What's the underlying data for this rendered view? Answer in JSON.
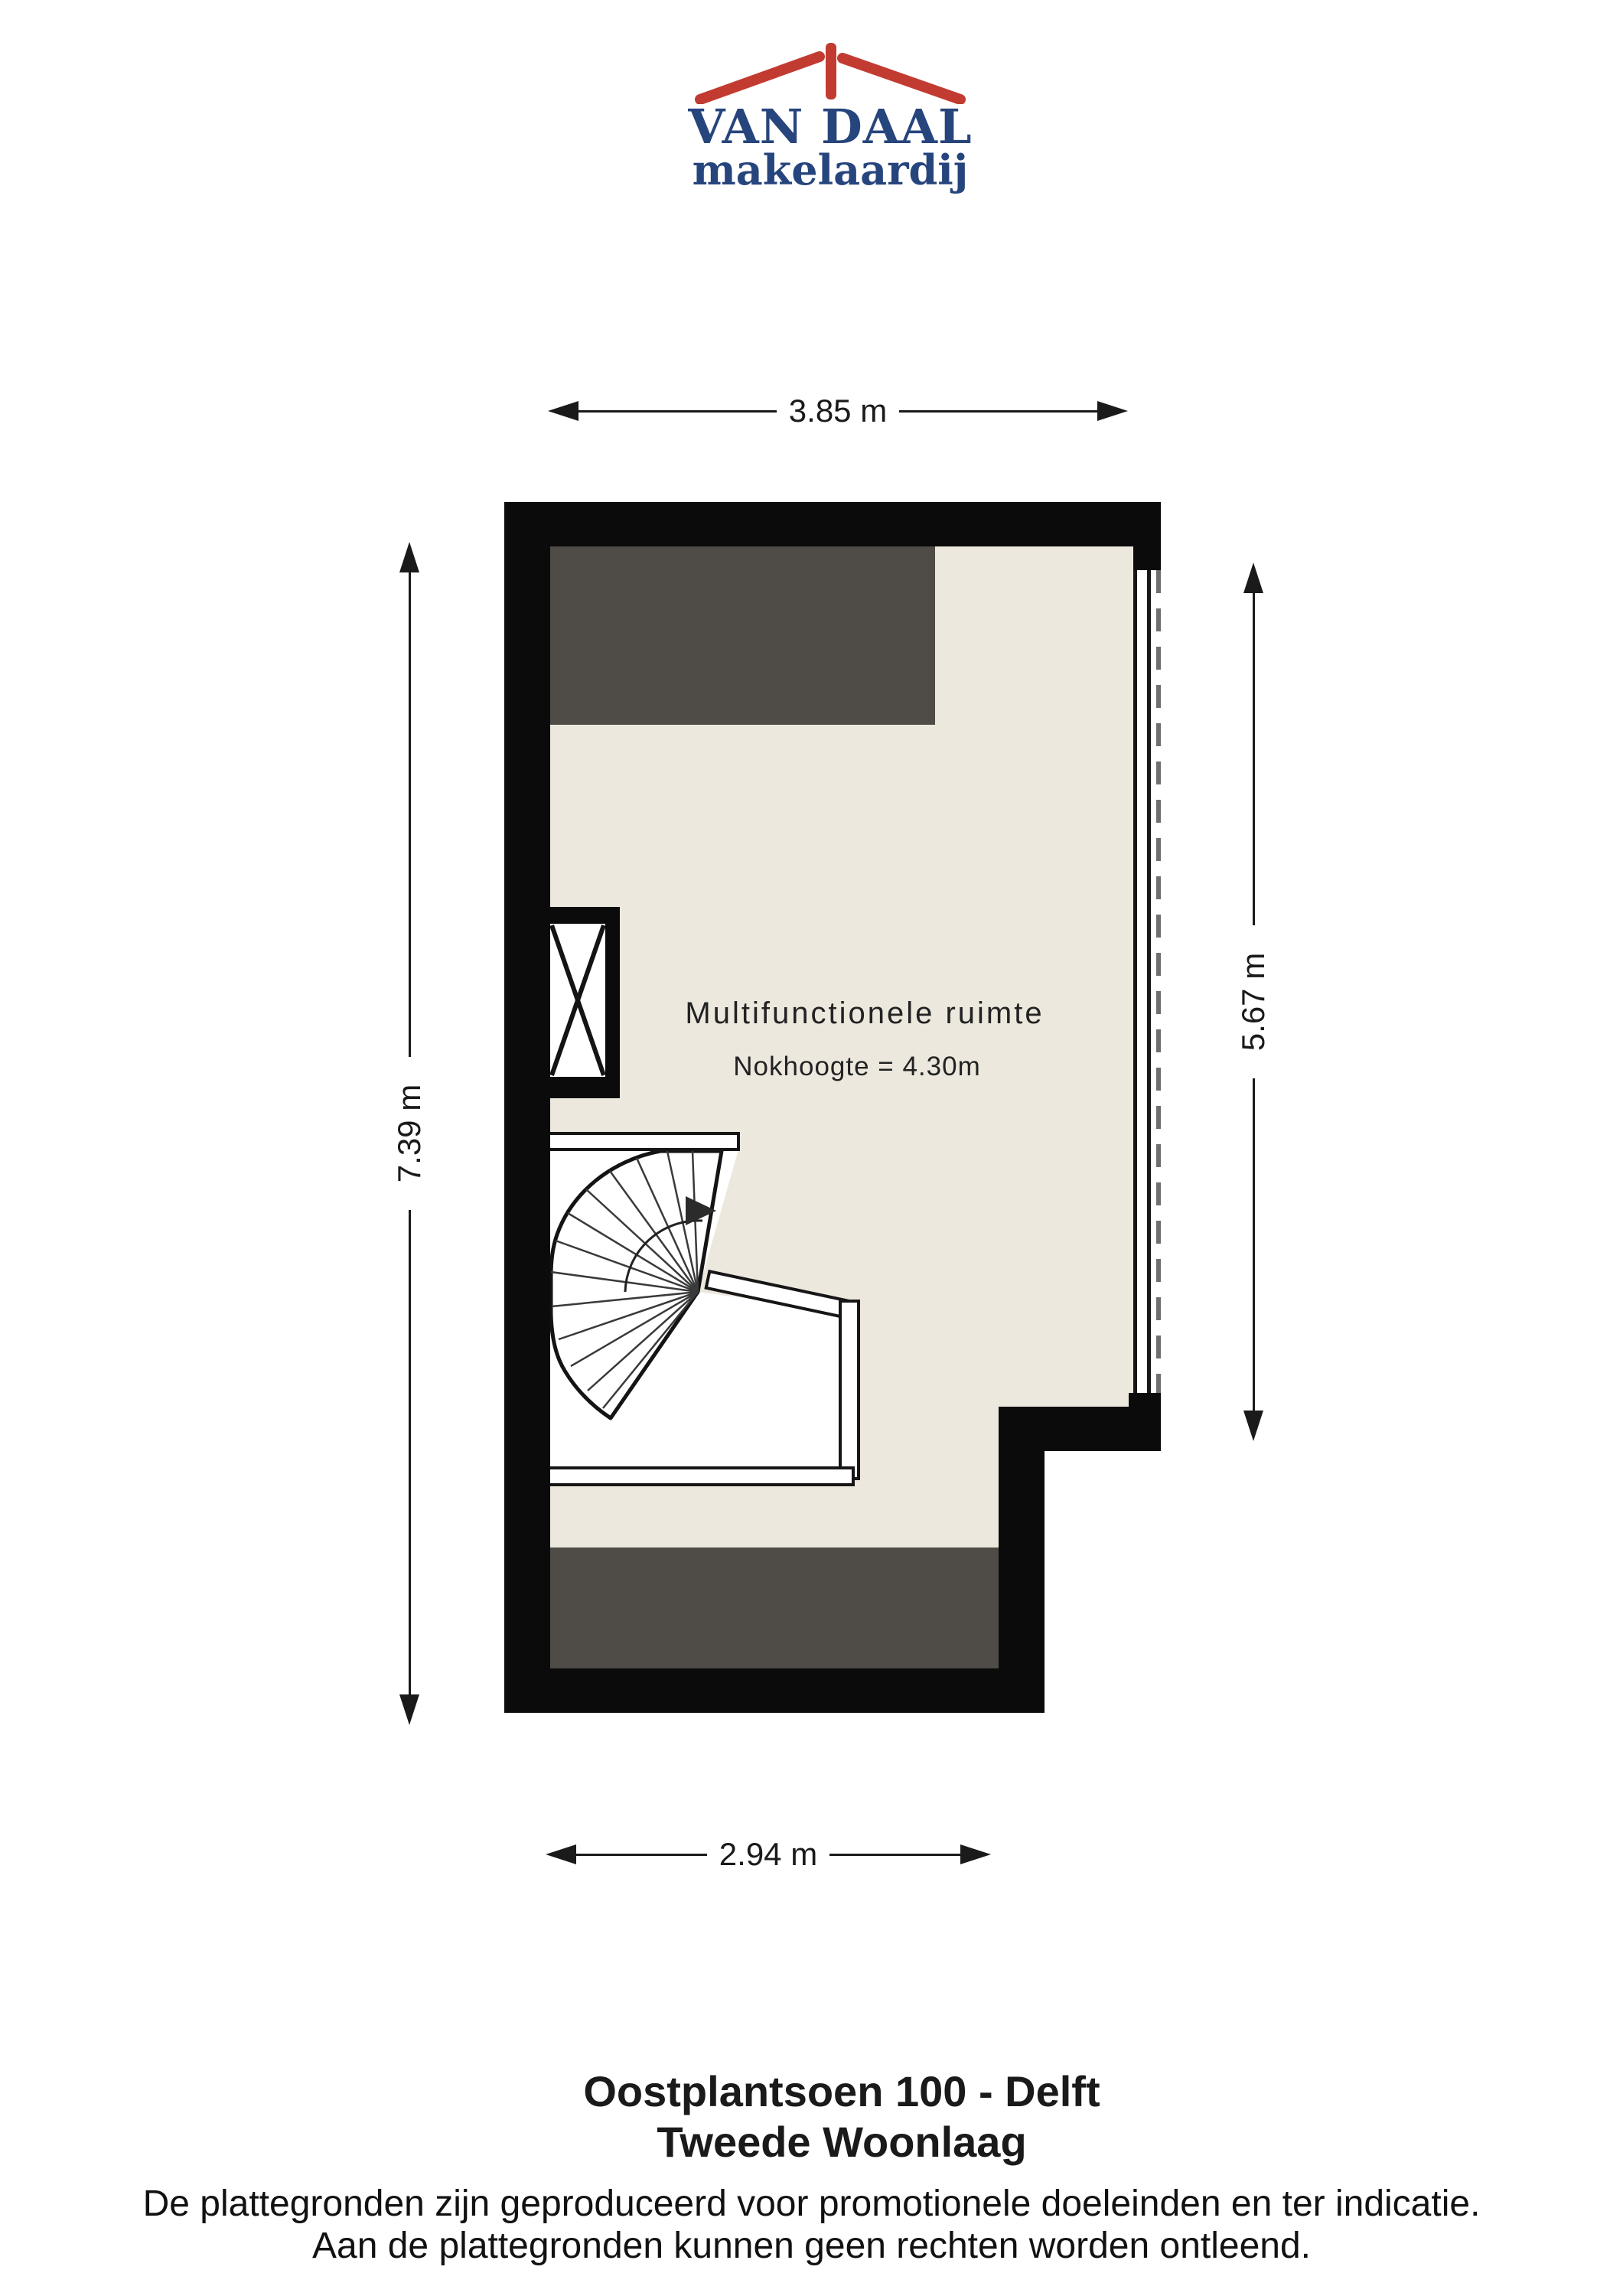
{
  "logo": {
    "title": "VAN DAAL",
    "subtitle": "makelaardij"
  },
  "dimensions": {
    "top": "3.85 m",
    "bottom": "2.94 m",
    "left": "7.39 m",
    "right": "5.67 m"
  },
  "room": {
    "name": "Multifunctionele ruimte",
    "height_note": "Nokhoogte = 4.30m"
  },
  "footer": {
    "address": "Oostplantsoen 100 - Delft",
    "floor": "Tweede Woonlaag",
    "disclaimer_line1": "De plattegronden zijn geproduceerd voor promotionele doeleinden en ter indicatie.",
    "disclaimer_line2": "Aan de plattegronden kunnen geen rechten worden ontleend."
  },
  "colors": {
    "wall": "#0b0b0b",
    "floor": "#ede8de",
    "low-ceiling": "#4f4c48",
    "logo-red": "#c23b31",
    "logo-blue": "#27457d",
    "dash": "#6f6f6f",
    "ink": "#1a1a1a"
  }
}
